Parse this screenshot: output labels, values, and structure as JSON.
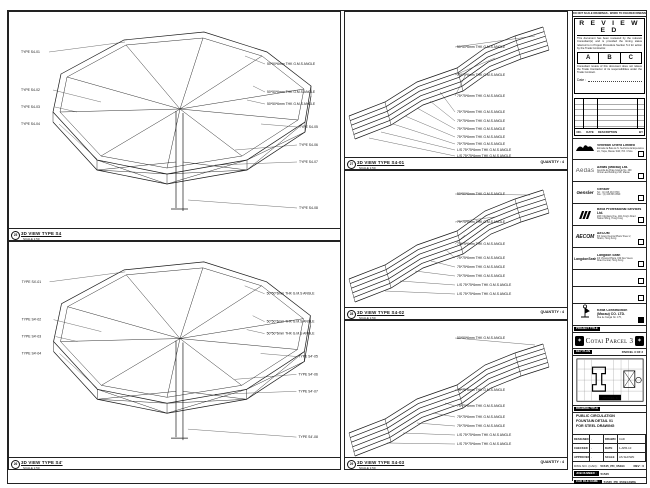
{
  "sheet_note": "DO NOT SCALE DRAWINGS - WORK TO FIGURED DIMENSIONS ONLY - VERIFY ALL DIMENSIONS ON SITE",
  "panels": {
    "s4": {
      "num": "25",
      "title": "3D VIEW TYPE S4",
      "scale": "SCALE 1:50",
      "left_labels": [
        "TYPE S4-01",
        "TYPE S4-02",
        "TYPE S4-03",
        "TYPE S4-04"
      ],
      "right_labels": [
        "50*50*6mm THK G.M.S ANGLE",
        "50*50*6mm THK G.M.S ANGLE",
        "50*50*6mm THK G.M.S ANGLE",
        "TYPE S4-05",
        "TYPE S4-06",
        "TYPE S4-07",
        "TYPE S4-08"
      ]
    },
    "s4p": {
      "num": "26",
      "title": "3D VIEW TYPE S4'",
      "scale": "SCALE 1:50",
      "left_labels": [
        "TYPE S4'-01",
        "TYPE S4'-02",
        "TYPE S4'-03",
        "TYPE S4'-04"
      ],
      "right_labels": [
        "50*50*6mm THK G.M.S ANGLE",
        "50*50*6mm THK G.M.S ANGLE",
        "50*50*6mm THK G.M.S ANGLE",
        "TYPE S4'-05",
        "TYPE S4'-06",
        "TYPE S4'-07",
        "TYPE S4'-08"
      ]
    },
    "s4_01": {
      "num": "27",
      "title": "3D VIEW TYPE S4-01",
      "scale": "SCALE 1:50",
      "quantity": "QUANTITY : 4",
      "labels": [
        "50*50*6mm THK G.M.S ANGLE",
        "75*75*6mm THK G.M.S ANGLE",
        "75*75*6mm THK G.M.S ANGLE",
        "75*75*6mm THK G.M.S ANGLE",
        "75*75*6mm THK G.M.S ANGLE",
        "75*75*6mm THK G.M.S ANGLE",
        "75*75*6mm THK G.M.S ANGLE",
        "75*75*6mm THK G.M.S ANGLE",
        "L/S 75*75*6mm THK G.M.S ANGLE",
        "L/S 75*75*6mm THK G.M.S ANGLE"
      ]
    },
    "s4_02": {
      "num": "28",
      "title": "3D VIEW TYPE S4-02",
      "scale": "SCALE 1:50",
      "quantity": "QUANTITY : 4",
      "labels": [
        "50*50*6mm THK G.M.S ANGLE",
        "75*75*6mm THK G.M.S ANGLE",
        "75*75*6mm THK G.M.S ANGLE",
        "75*75*6mm THK G.M.S ANGLE",
        "75*75*6mm THK G.M.S ANGLE",
        "75*75*6mm THK G.M.S ANGLE",
        "L/S 75*75*6mm THK G.M.S ANGLE",
        "L/S 75*75*6mm THK G.M.S ANGLE"
      ]
    },
    "s4_03": {
      "num": "29",
      "title": "3D VIEW TYPE S4-03",
      "scale": "SCALE 1:50",
      "quantity": "QUANTITY : 4",
      "labels": [
        "50*50*6mm THK G.M.S ANGLE",
        "75*75*6mm THK G.M.S ANGLE",
        "75*75*6mm THK G.M.S ANGLE",
        "75*75*6mm THK G.M.S ANGLE",
        "75*75*6mm THK G.M.S ANGLE",
        "L/S 75*75*6mm THK G.M.S ANGLE",
        "L/S 75*75*6mm THK G.M.S ANGLE"
      ]
    }
  },
  "titleblock": {
    "reviewed": {
      "title": "R E V I E W E D",
      "para1": "This document has been reviewed by the relevant Consultant(s) and is provided the timing status referred to in Project Procedure Section 5.4 for action by the Trade Contractor.",
      "grades": [
        "A",
        "B",
        "C"
      ],
      "para2": "Consultant review of this document does not relieve the Trade Contractor of its responsibilities under the Trade Contract.",
      "date_label": "Date :"
    },
    "revisions": {
      "headers": [
        "NO.",
        "DATE",
        "DESCRIPTION",
        "BY"
      ]
    },
    "companies": [
      {
        "name": "Venetian Orient Limited",
        "d1": "Estrada da Baia de N. Senhora da Esperanca",
        "d2": "s/n, Taipa, Macau SAR, P.R. China"
      },
      {
        "logo_text": "Aedas",
        "name": "Aedas (Macau) Ltd.",
        "d1": "Avenida da Praia Grande No. 409",
        "d2": "China Law Building 21/F, Macau"
      },
      {
        "logo_text": "Gensler",
        "name": "Gensler",
        "d1": "Tel : (1) 415 433 3700",
        "d2": "Fax : (1) 415 836 4599"
      },
      {
        "name": "Beca Professional Services Ltd.",
        "d1": "20/F Cityplaza One, 1111 King's Road",
        "d2": "Taikoo Shing, Hong Kong"
      },
      {
        "logo_text": "AECOM",
        "name": "AECOM",
        "d1": "8/F Grand Central Plaza Tower 2,",
        "d2": "Shatin, Hong Kong"
      },
      {
        "logo_text": "LangdonSeah",
        "name": "Langdon Seah",
        "d1": "4/F Vicwood Plaza, 199 Des Voeux",
        "d2": "Road Central, Hong Kong"
      },
      {
        "name": "Keda Construction",
        "name2": "(Macau) CO. LTD.",
        "d1": "Rua de Xangai No. 175,",
        "d2": "Edf. ACM 13/F, Macau"
      }
    ],
    "project": {
      "label": "PROJECT TITLE",
      "name": "Cotai Parcel 3"
    },
    "key_plan": {
      "label": "KEY PLAN",
      "note": "PARCEL 3 OF 3",
      "tag": "PARCEL 3"
    },
    "drawing_title": {
      "label": "DRAWING TITLE",
      "line1": "PUBLIC CIRCULATION",
      "line2": "FOUNTAIN DETAIL 01",
      "line3": "FOR STEEL DRAWING"
    },
    "info": {
      "designed_label": "DESIGNED",
      "designed": "-",
      "drawn_label": "DRAWN",
      "drawn": "CAD",
      "checked_label": "CHECKED",
      "checked": "-",
      "date_label": "DATE",
      "date": "1-APR-10",
      "approved_label": "APPROVED",
      "approved": "-",
      "scale_label": "SCALE",
      "scale": "AS SHOWN"
    },
    "dwg": {
      "label": "DWG NO. (CAD) :",
      "value": "51545_PD_05494",
      "rev_label": "REV : 0"
    },
    "job": {
      "label": "JOB NUMBER :",
      "value": "51545"
    },
    "cad": {
      "label": "CAD FILE NAME :",
      "value": "51545_PD_05494.DWG"
    }
  }
}
